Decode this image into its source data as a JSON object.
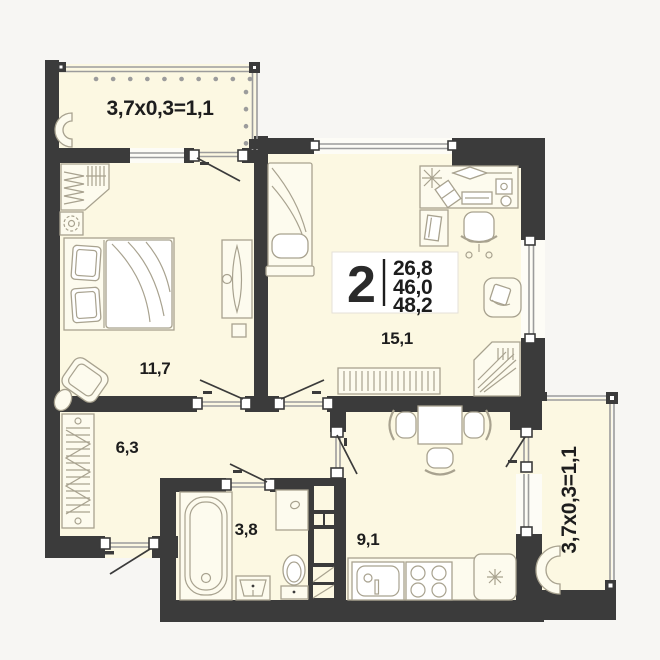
{
  "info_box": {
    "rooms_count": "2",
    "area_lines": [
      "26,8",
      "46,0",
      "48,2"
    ]
  },
  "room_labels": {
    "bedroom": "11,7",
    "living_room": "15,1",
    "hallway": "6,3",
    "bathroom": "3,8",
    "kitchen": "9,1"
  },
  "balcony_labels": {
    "top": "3,7x0,3=1,1",
    "right": "3,7x0,3=1,1"
  },
  "colors": {
    "wall": "#3b3b3b",
    "floor": "#fcf8e2",
    "furniture_stroke": "#a8a28f",
    "background": "#f7f6f3",
    "glazing": "#9c9c9c",
    "text": "#1d1d1d"
  }
}
